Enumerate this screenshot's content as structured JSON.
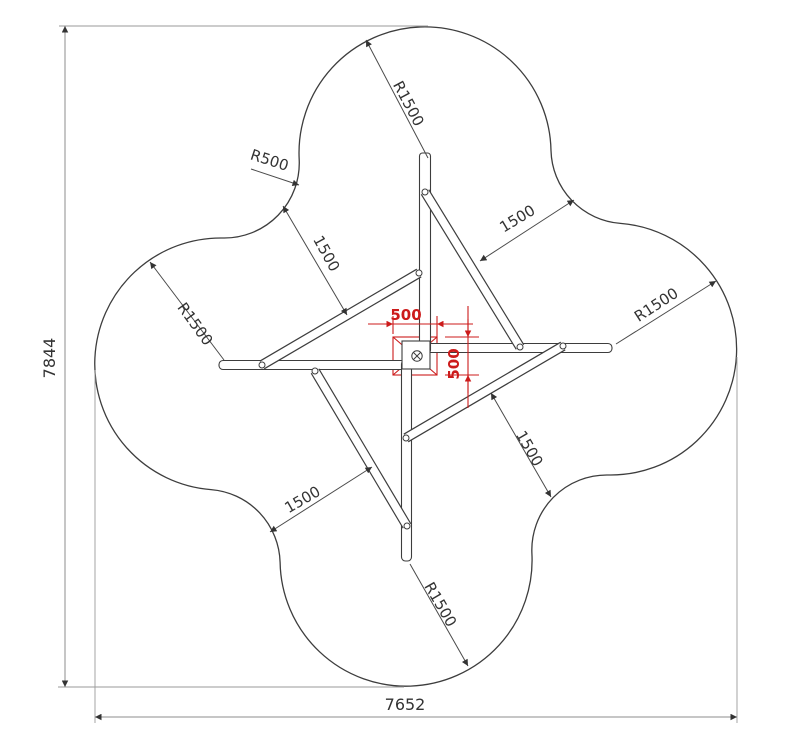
{
  "drawing": {
    "type": "technical-plan-view",
    "subject": "four-arm pinwheel play structure with clover safety area",
    "colors": {
      "background": "#ffffff",
      "line": "#3d3d3d",
      "dimension_line": "#8c8c8c",
      "text": "#333333",
      "accent_red": "#cc1b1b"
    },
    "labels": {
      "overall_height": "7844",
      "overall_width": "7652",
      "fillet_radius": "R500",
      "lobe_radius_top": "R1500",
      "lobe_radius_left": "R1500",
      "lobe_radius_right": "R1500",
      "lobe_radius_bottom": "R1500",
      "clearance_top_left": "1500",
      "clearance_top_right": "1500",
      "clearance_bottom_right": "1500",
      "clearance_bottom_left": "1500",
      "hub_width": "500",
      "hub_height": "500"
    }
  }
}
